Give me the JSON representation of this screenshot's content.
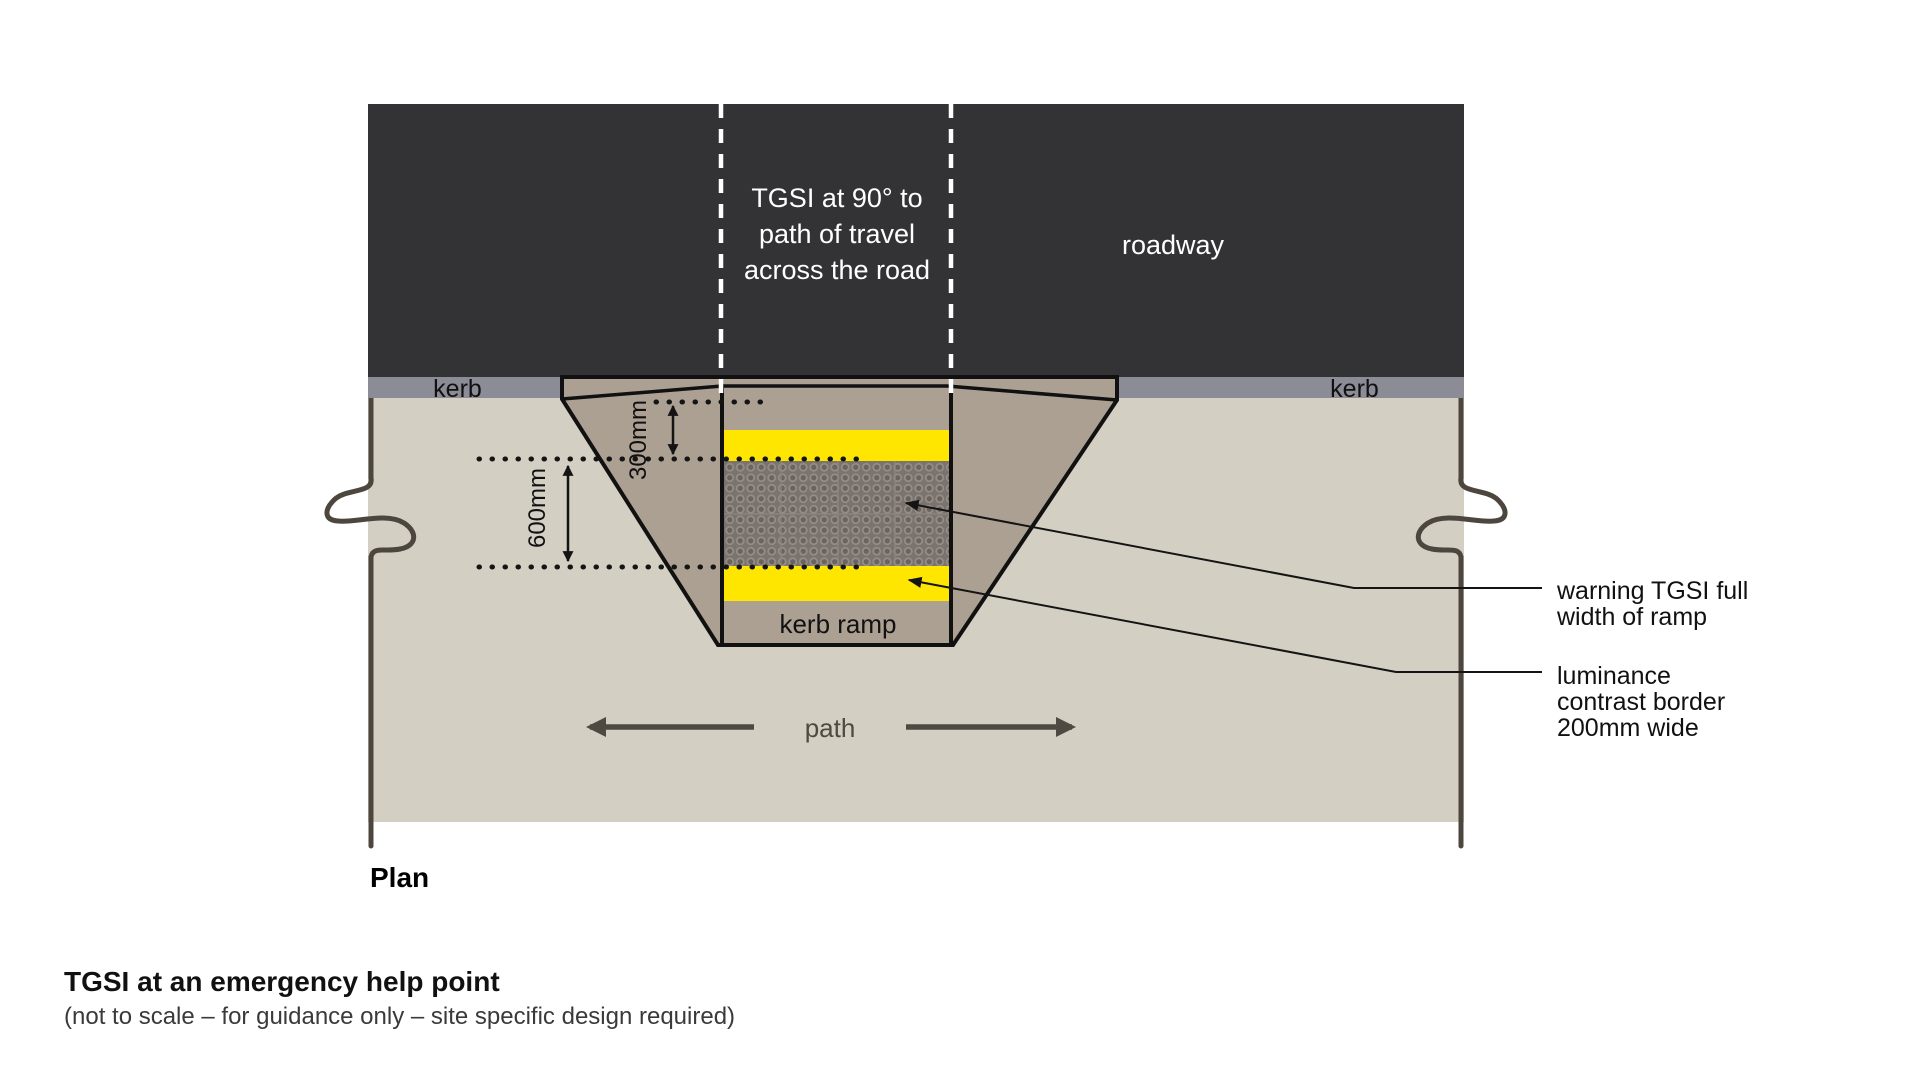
{
  "colors": {
    "roadway": "#333336",
    "kerb": "#8c8c96",
    "footpath": "#d3cfc3",
    "ramp": "#aca093",
    "yellow_border": "#ffe600",
    "tgsi_base": "#7b746e",
    "dashed_centerline": "#ffffff",
    "outline": "#111111",
    "break_line": "#4d463f",
    "path_arrow": "#4e4941"
  },
  "roadway": {
    "label": "roadway",
    "note_line1": "TGSI at 90° to",
    "note_line2": "path of travel",
    "note_line3": "across the road"
  },
  "kerb": {
    "left_label": "kerb",
    "right_label": "kerb"
  },
  "ramp": {
    "label": "kerb ramp"
  },
  "dimensions": {
    "setback": "300mm",
    "tgsi_depth": "600mm"
  },
  "footpath": {
    "label": "path"
  },
  "annotations": {
    "warning_line1": "warning TGSI full",
    "warning_line2": "width of ramp",
    "border_line1": "luminance",
    "border_line2": "contrast border",
    "border_line3": "200mm wide"
  },
  "plan_label": "Plan",
  "caption": {
    "title": "TGSI at an emergency help point",
    "subtitle": "(not to scale – for guidance only – site specific design required)"
  }
}
